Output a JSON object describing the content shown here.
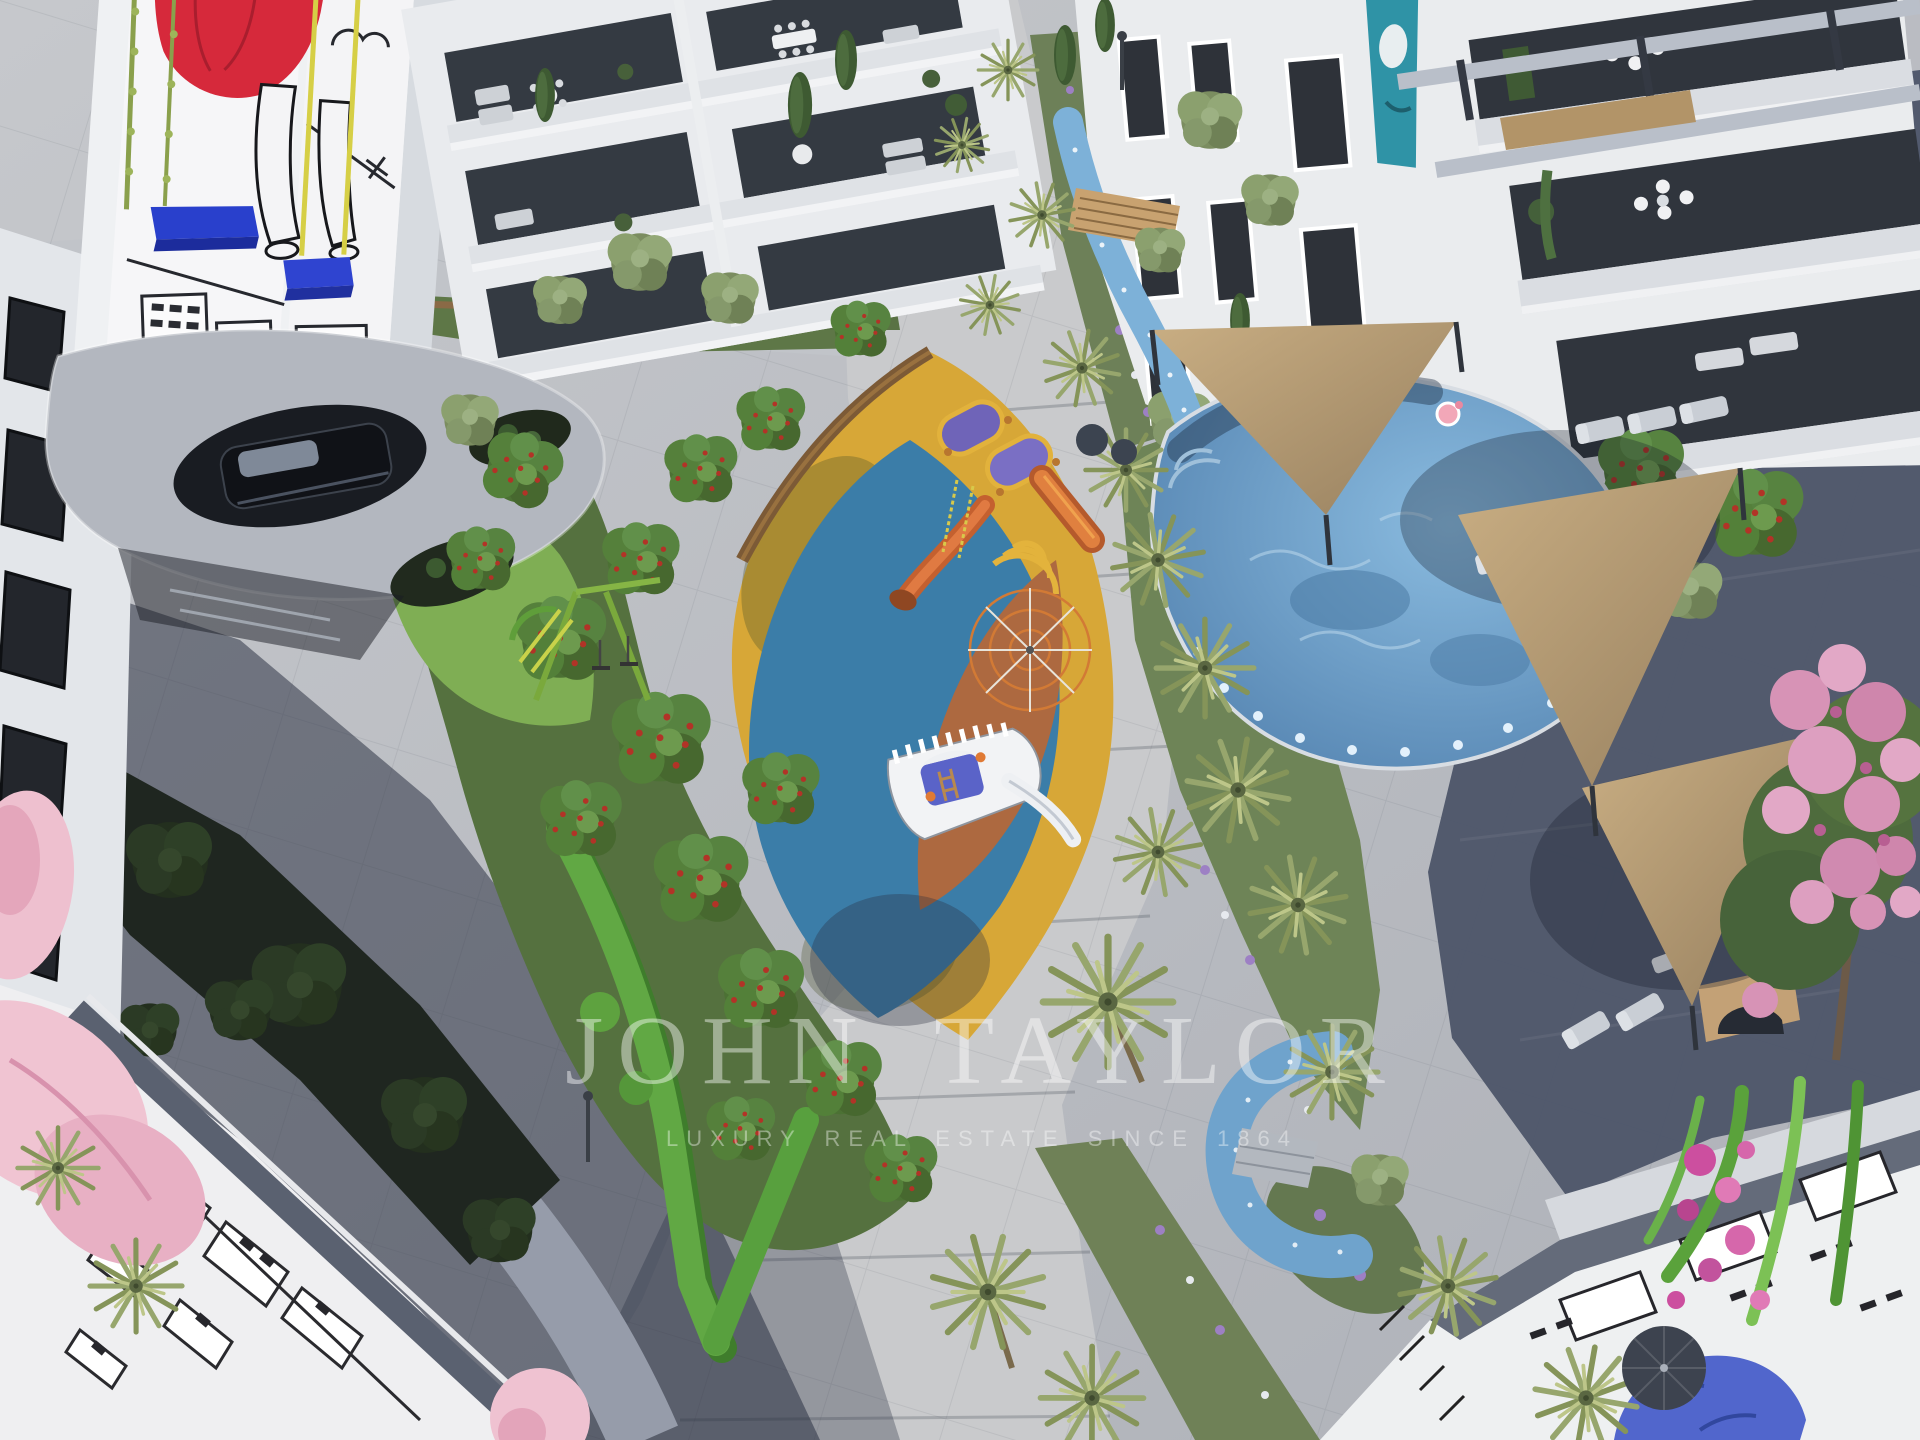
{
  "image": {
    "kind": "aerial-architectural-rendering",
    "subject": "residential complex courtyard with playground, swimming pool, palm gardens and painted murals"
  },
  "watermark": {
    "title": "JOHN TAYLOR",
    "subtitle": "LUXURY REAL ESTATE SINCE 1864",
    "color": "rgba(255,255,255,0.44)"
  },
  "palette": {
    "paving_light": "#c2c5ca",
    "paving_shaded": "#4b5468",
    "building_white": "#eceef0",
    "glass_dark": "#30353d",
    "playground_yellow": "#d7a737",
    "playground_blue": "#3b7da8",
    "playground_terracotta": "#ad6940",
    "pool_water": "#5b8ab4",
    "stream_blue": "#7db1d8",
    "sail_tan": "#b49a76",
    "hedge_green": "#61a844",
    "tree_green": "#4c7134",
    "palm_green": "#97a66d",
    "mural_red": "#d6293b",
    "swing_blue": "#2940cc",
    "flower_pink": "#e8b0c4",
    "flower_magenta": "#cc4f9f",
    "lavender": "#9d80c4",
    "wood": "#8a6a46"
  },
  "scene": {
    "elements": [
      "mural-tower-with-swing",
      "parking-canopy-with-car",
      "apartment-terraces",
      "leaf-shaped-playground",
      "rope-pyramid-climber",
      "ship-playhouse",
      "tube-slide",
      "swing-frame",
      "berry-trees",
      "hedge-chevron",
      "palm-alley",
      "stream-with-bridge",
      "organic-pool-with-lights",
      "flamingo-float",
      "shade-sails",
      "sun-loungers",
      "pink-flowering-tree",
      "rooftop-murals",
      "lavender-flower-beds"
    ]
  }
}
